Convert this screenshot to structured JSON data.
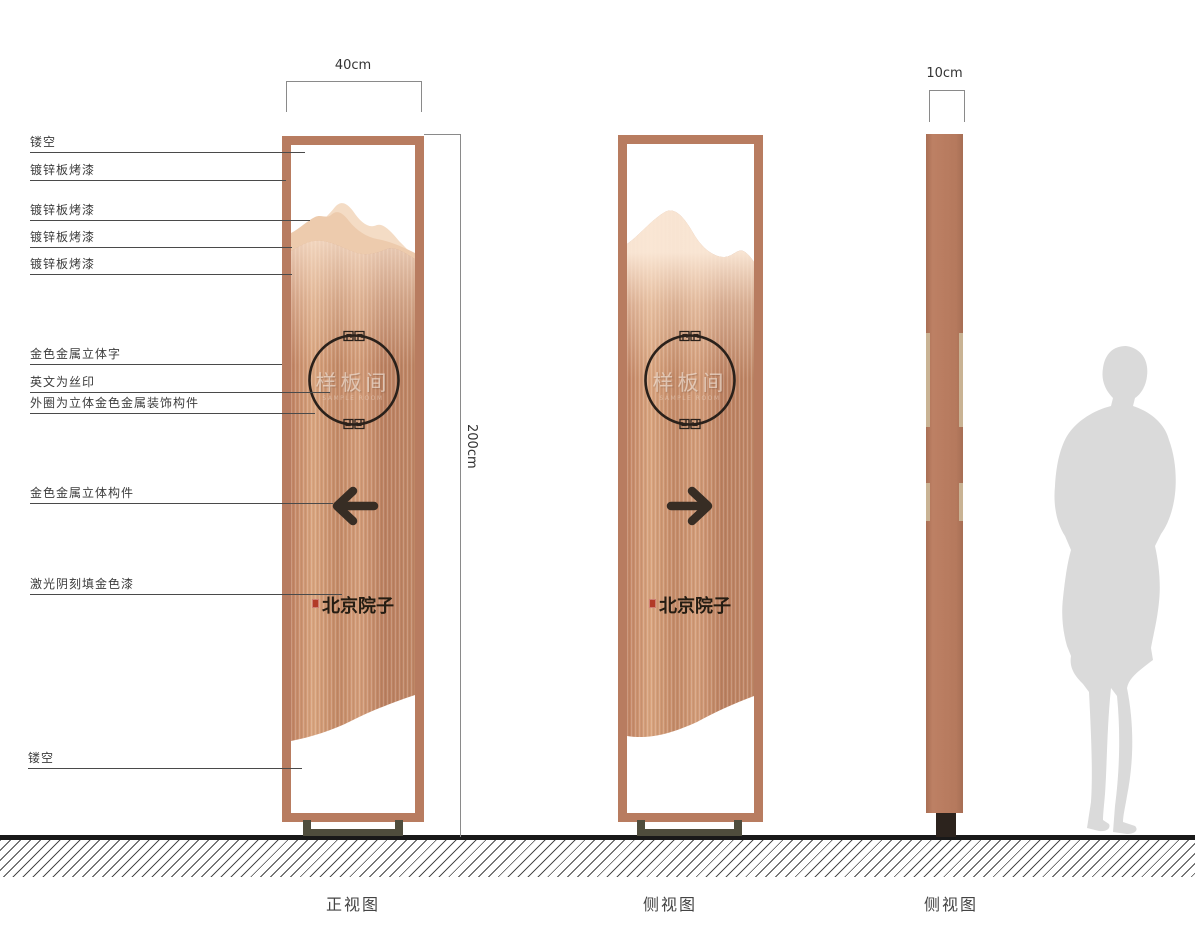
{
  "drawing": {
    "subject": "totem-signage-specification",
    "annotations": [
      {
        "label": "镂空"
      },
      {
        "label": "镀锌板烤漆"
      },
      {
        "label": "镀锌板烤漆"
      },
      {
        "label": "镀锌板烤漆"
      },
      {
        "label": "镀锌板烤漆"
      },
      {
        "label": "金色金属立体字"
      },
      {
        "label": "英文为丝印"
      },
      {
        "label": "外圈为立体金色金属装饰构件"
      },
      {
        "label": "金色金属立体构件"
      },
      {
        "label": "激光阴刻填金色漆"
      },
      {
        "label": "镂空"
      }
    ],
    "dimensions": {
      "front_width": "40cm",
      "total_height": "200cm",
      "side_width": "10cm"
    },
    "views": [
      {
        "label": "正视图"
      },
      {
        "label": "侧视图"
      },
      {
        "label": "侧视图"
      }
    ],
    "sign": {
      "room_name": "样板间",
      "room_name_en": "SAMPLE ROOM",
      "brand_name": "北京院子"
    },
    "colors": {
      "frame_copper": "#b87c60",
      "mountain_light": "#f4dcc5",
      "mountain_mid": "#edcbad",
      "texture_copper": "#c98f6e",
      "edge_strip_tan": "#c9b394",
      "base_olive": "#4f4d3d",
      "side_base_dark": "#2c231d",
      "ground_black": "#191919",
      "silhouette_gray": "#dadada",
      "arrow_dark": "#372d24",
      "circle_dark": "#2a211b",
      "seal_red": "#b23b28"
    }
  }
}
